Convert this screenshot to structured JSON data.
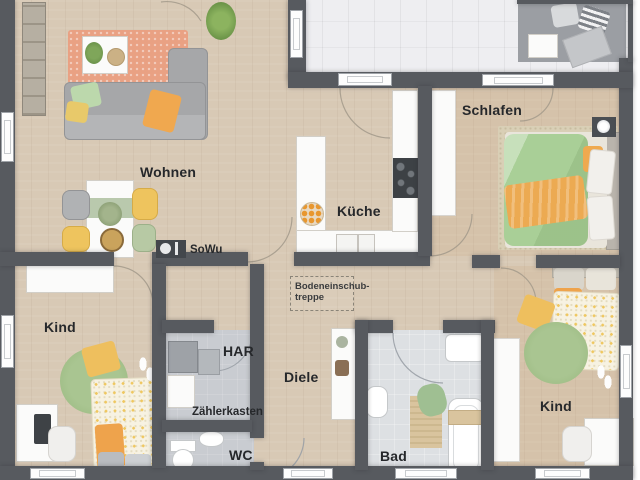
{
  "plan": {
    "title": "Erdgeschoss Grundriss",
    "rooms": {
      "wohnen": "Wohnen",
      "kueche": "Küche",
      "schlafen": "Schlafen",
      "kind_left": "Kind",
      "kind_right": "Kind",
      "diele": "Diele",
      "har": "HAR",
      "wc": "WC",
      "bad": "Bad"
    },
    "annotations": {
      "sowu": "SoWu",
      "zaehlerkasten": "Zählerkasten",
      "attic_stairs_line1": "Bodeneinschub-",
      "attic_stairs_line2": "treppe"
    },
    "colors": {
      "wall": "#575a5f",
      "wood_floor": "#d8c9b5",
      "terrace_tile": "#eeeef1",
      "utility_tile": "#c9ccd1",
      "bath_tile": "#dde0e3",
      "rug_living": "#e9a183",
      "rug_kids": "#a9c591",
      "accent_orange": "#eca14e",
      "accent_green": "#a9cf97",
      "accent_yellow": "#eec45e",
      "label_text": "#26282b"
    }
  }
}
